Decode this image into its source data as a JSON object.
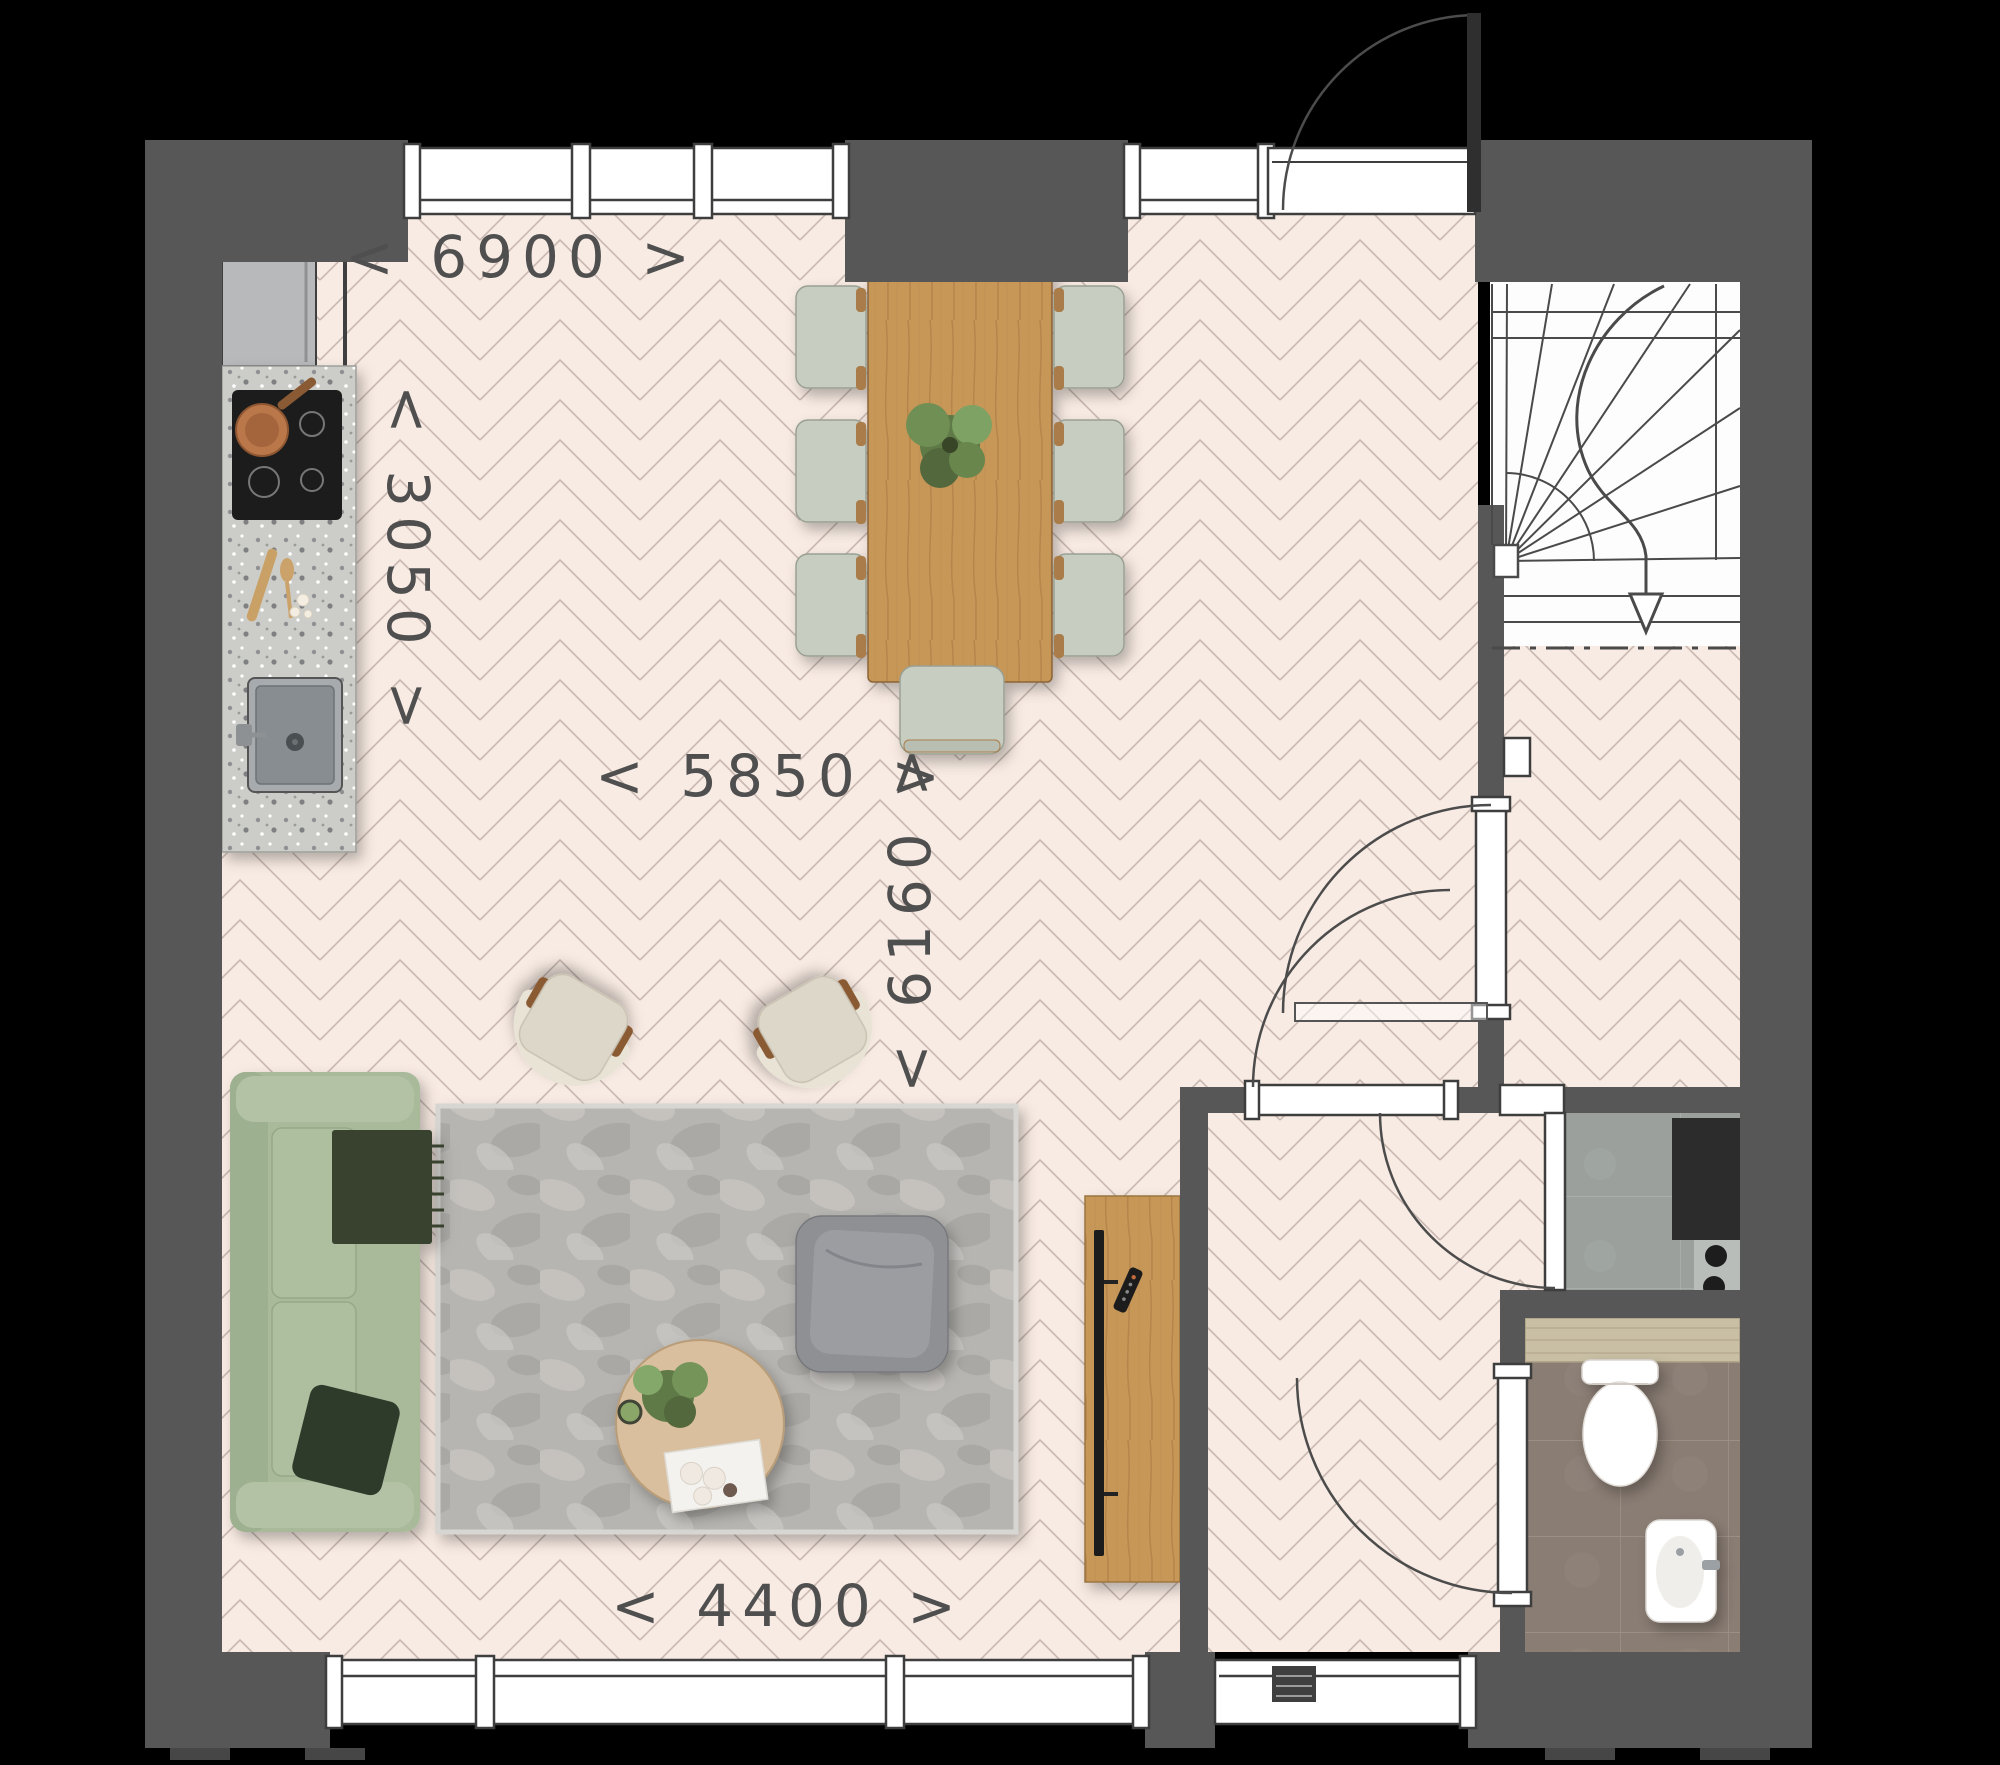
{
  "dimensions": {
    "top_width": {
      "label": "< 6900 >",
      "orientation": "horizontal"
    },
    "kitchen_depth": {
      "label": "< 3050 >",
      "orientation": "vertical"
    },
    "living_width": {
      "label": "< 5850 >",
      "orientation": "horizontal"
    },
    "living_depth": {
      "label": "< 6160 >",
      "orientation": "vertical"
    },
    "bottom_width": {
      "label": "< 4400 >",
      "orientation": "horizontal"
    }
  },
  "colors": {
    "background": "#000000",
    "wall": "#575757",
    "parquet_base": "#f8ebe3",
    "parquet_line": "#b4a29b",
    "stair_background": "#fdfdfd",
    "window_fill": "#ffffff",
    "window_stroke": "#3e3e3e",
    "sofa": "#a9ba9b",
    "throw_blanket": "#39432f",
    "rug": "#b7b5b1",
    "table_wood": "#c79758",
    "coffee_table": "#d9bf9e",
    "dining_chair": "#c8cdc2",
    "armchair": "#ddd7c9",
    "pouf": "#8e9094",
    "tech_tile": "#9ba09d",
    "wc_tile": "#8a7d74",
    "wc_shelf_wood": "#c9bfa5",
    "counter_terrazzo": "#cccdc8",
    "hob": "#1c1c1c",
    "copper_pan": "#bf7a4b",
    "plant_green": "#6d8f52",
    "fridge": "#b7b9bb",
    "dimension_text": "#4f4f4f"
  }
}
